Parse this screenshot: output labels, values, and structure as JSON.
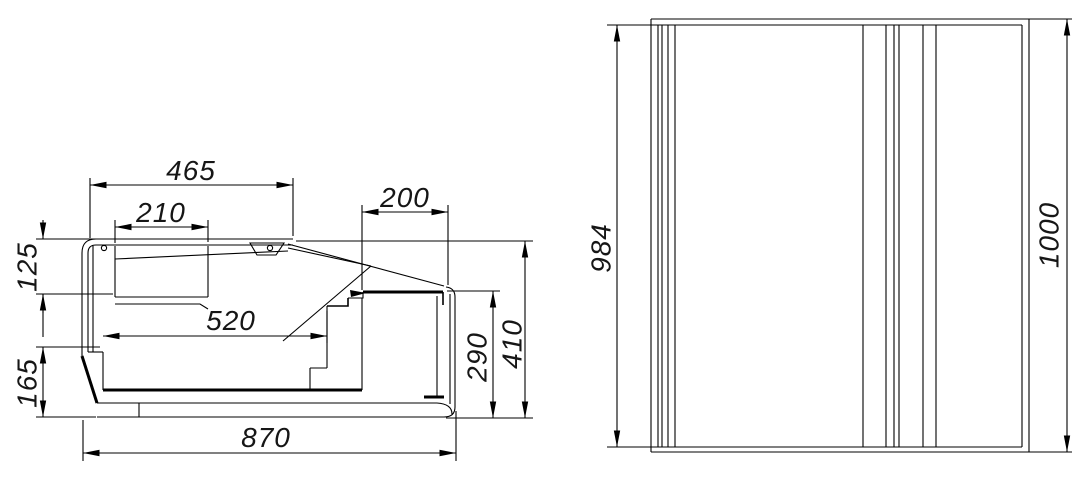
{
  "drawing": {
    "type": "technical-drawing",
    "views": {
      "side_section": {
        "label": "side-section-view",
        "dims": {
          "w465": "465",
          "w210": "210",
          "w200": "200",
          "w520": "520",
          "w870": "870",
          "h125": "125",
          "h165": "165",
          "h290": "290",
          "h410": "410"
        }
      },
      "plan": {
        "label": "plan-view",
        "dims": {
          "h984": "984",
          "h1000": "1000"
        }
      }
    },
    "line_color": "#000000",
    "background_color": "#ffffff"
  }
}
